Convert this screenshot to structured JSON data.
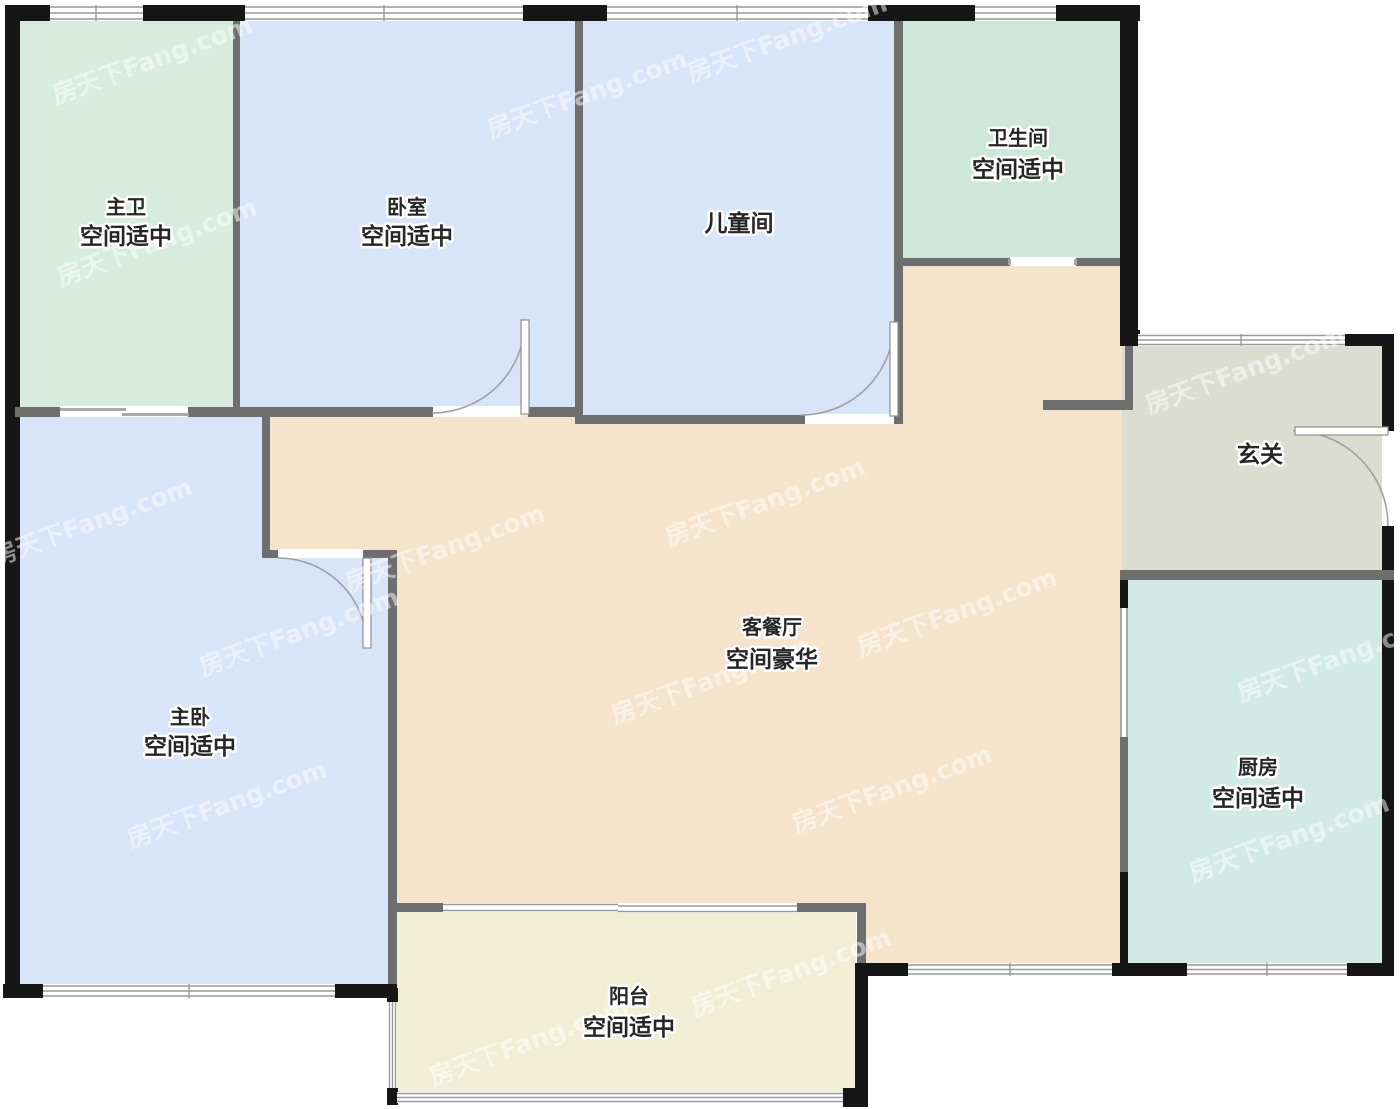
{
  "watermark": "房天下Fang.com",
  "colors": {
    "wall_exterior": "#161616",
    "wall_interior": "#6e6e6e",
    "window_line": "#999999",
    "door_line": "#a0a0a0",
    "label_text": "#262626",
    "background": "#ffffff"
  },
  "rooms": {
    "master_bath": {
      "name": "主卫",
      "subtitle": "空间适中",
      "color": "#d7ecdf"
    },
    "bedroom": {
      "name": "卧室",
      "subtitle": "空间适中",
      "color": "#d8e4f8"
    },
    "kids_room": {
      "name": "儿童间",
      "subtitle": "",
      "color": "#d8e4f8"
    },
    "bathroom": {
      "name": "卫生间",
      "subtitle": "空间适中",
      "color": "#cfe7db"
    },
    "foyer": {
      "name": "玄关",
      "subtitle": "",
      "color": "#dcddd1"
    },
    "living_dining": {
      "name": "客餐厅",
      "subtitle": "空间豪华",
      "color": "#f6e3cb"
    },
    "master_bedroom": {
      "name": "主卧",
      "subtitle": "空间适中",
      "color": "#d8e4f8"
    },
    "kitchen": {
      "name": "厨房",
      "subtitle": "空间适中",
      "color": "#d2eae5"
    },
    "balcony": {
      "name": "阳台",
      "subtitle": "空间适中",
      "color": "#f0efd6"
    }
  }
}
